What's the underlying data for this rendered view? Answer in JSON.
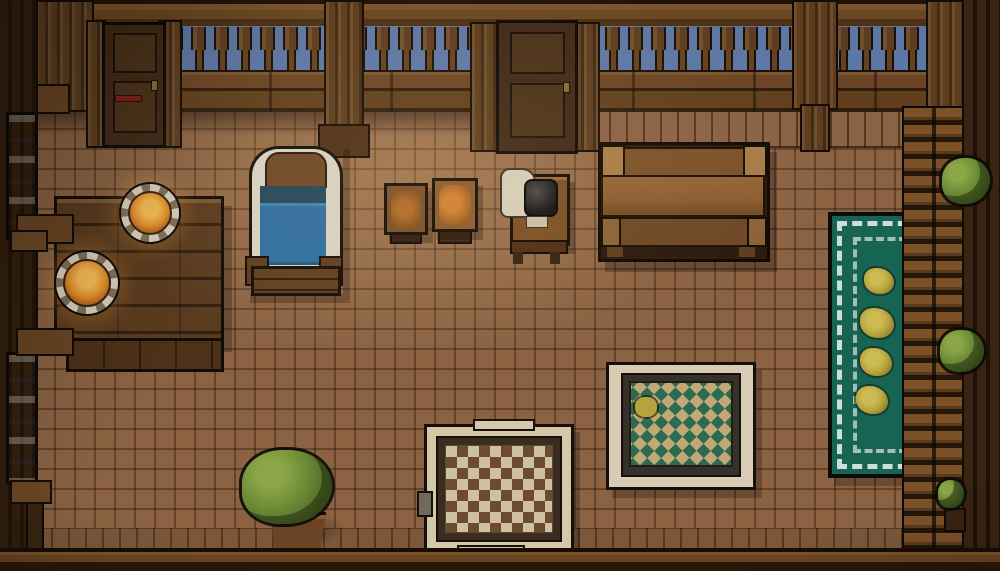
{
  "meta": {
    "title": "Top-down pixel-art tavern room at night",
    "style": "16-bit pixel RPG interior",
    "time_of_day": "night"
  },
  "colors": {
    "sky": "#5d77a4",
    "wallDark": "#261608",
    "floorTile": "#8b6343",
    "food": "#e58f2b",
    "foodGlow": "#f7bc55",
    "blanket": "#2f6f9f",
    "bedTeal": "#24485a",
    "bedFrame": "#d8d2c2",
    "headboard": "#6d4728",
    "rugGreen": "#186453",
    "rugWhite": "#cfdeda",
    "flower": "#b7a33c",
    "diamondGreen": "#2c6b50",
    "diamondTan": "#c2a877",
    "checkerCream": "#cfc0a0",
    "checkerBrown": "#6d4b30",
    "bush": "#6d8b36",
    "bushLight": "#8aa647",
    "bushDark": "#3a501d"
  },
  "objects": {
    "door_left": {
      "label": "Wooden door (left)"
    },
    "door_middle": {
      "label": "Wooden door (middle)"
    },
    "railing": {
      "label": "Balcony railing against night sky"
    },
    "window_upper": {
      "label": "Tall window, night sky"
    },
    "window_lower": {
      "label": "Tall window, night sky"
    },
    "dining_table": {
      "label": "Large plank table"
    },
    "table_bench": {
      "label": "Bench seat"
    },
    "plate_upper": {
      "label": "Plate with glowing hot food"
    },
    "plate_lower": {
      "label": "Plate with glowing hot food"
    },
    "bed": {
      "label": "Single bed with blue blanket"
    },
    "stool_left": {
      "label": "Wooden stool with food"
    },
    "stool_right": {
      "label": "Wooden stool with food"
    },
    "kettle_stand": {
      "label": "Side table with black kettle and cloth"
    },
    "bench": {
      "label": "Wooden bench"
    },
    "runner_rug": {
      "label": "Green runner rug with four flowers"
    },
    "diamond_rug": {
      "label": "Diamond-pattern rug"
    },
    "checkered_rug": {
      "label": "Checkered rug"
    },
    "potted_plant": {
      "label": "Potted bush"
    },
    "shelf_unit": {
      "label": "Wall shelf unit"
    },
    "shelf_bush_upper": {
      "label": "Shelf plant (upper)"
    },
    "shelf_bush_lower": {
      "label": "Shelf plant (lower)"
    },
    "corner_plant": {
      "label": "Small corner plant"
    }
  }
}
